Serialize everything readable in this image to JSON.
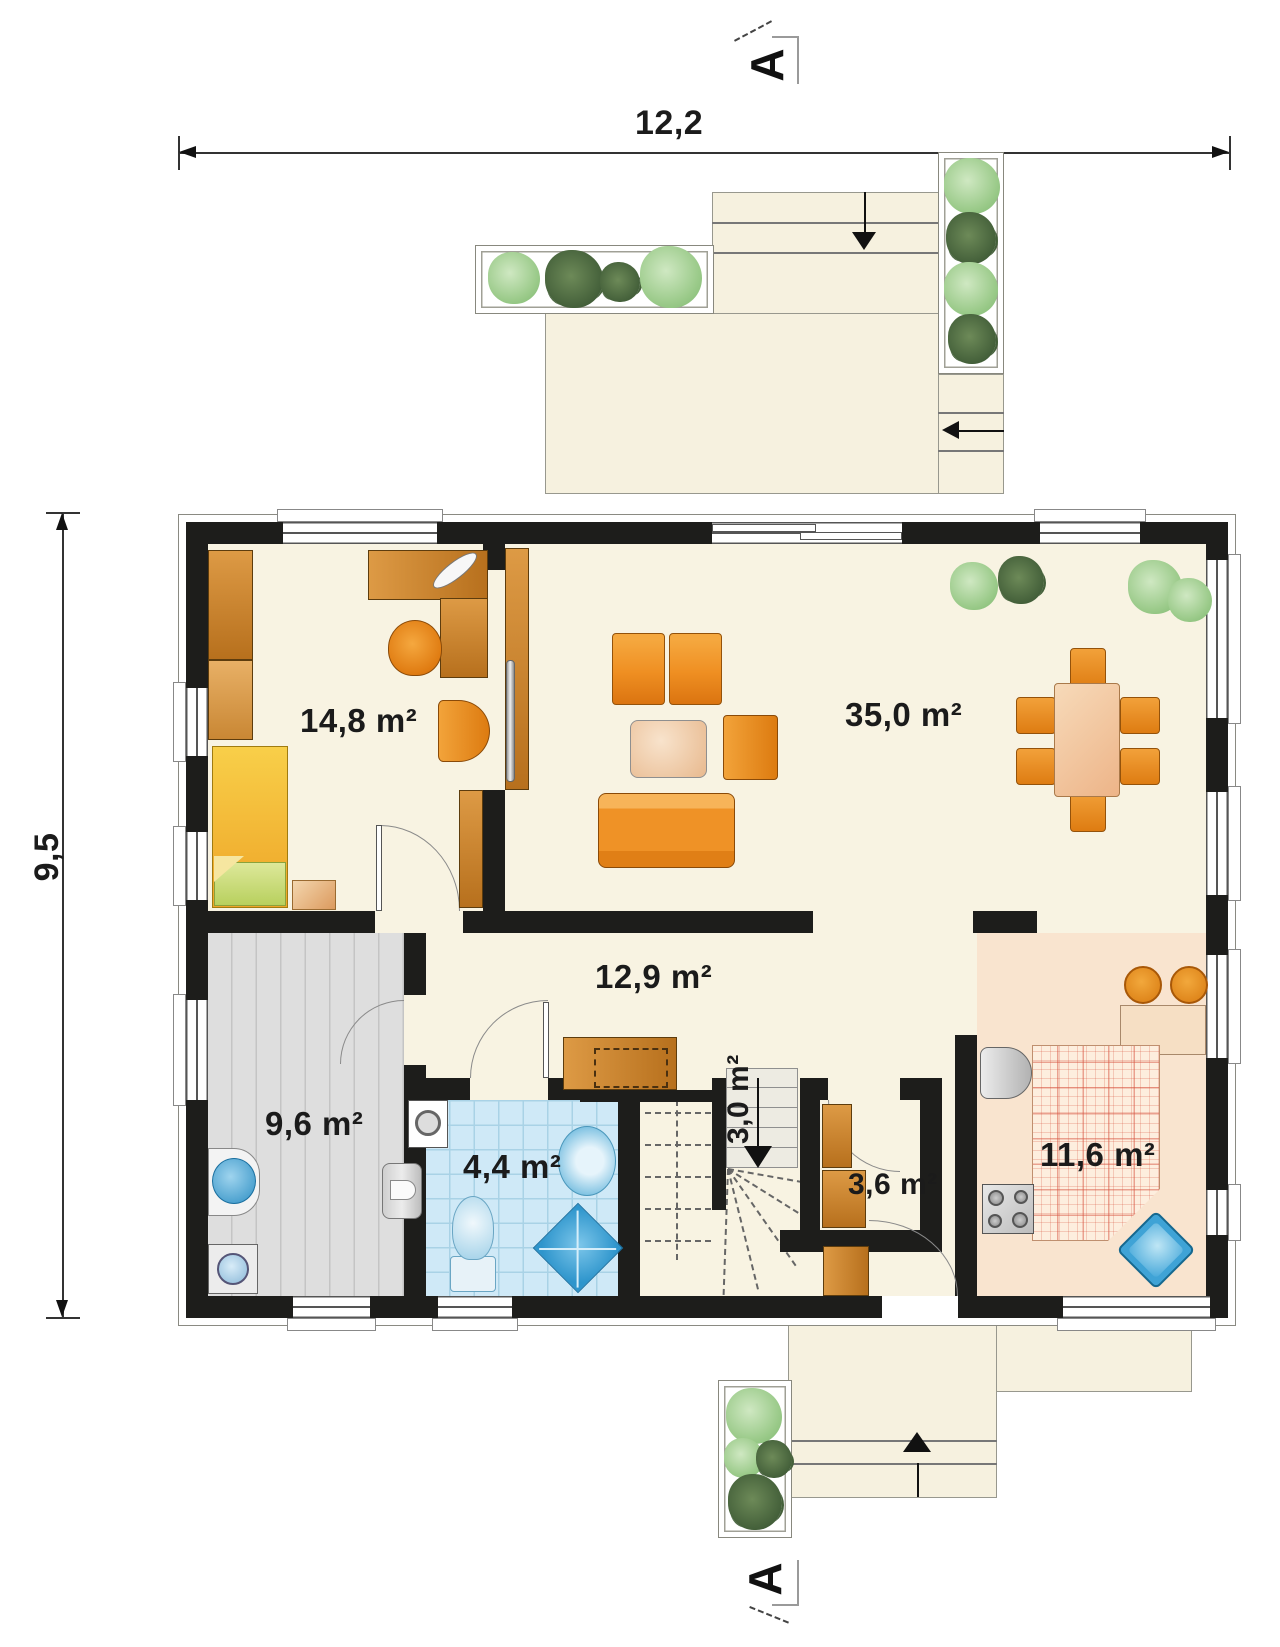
{
  "plan": {
    "title": "ground-floor-plan",
    "dimension_width": "12,2",
    "dimension_height": "9,5",
    "section_marker": "A",
    "rooms": [
      {
        "name": "bedroom",
        "area": "14,8 m²"
      },
      {
        "name": "living-dining",
        "area": "35,0 m²"
      },
      {
        "name": "hall",
        "area": "12,9 m²"
      },
      {
        "name": "utility",
        "area": "9,6 m²"
      },
      {
        "name": "bathroom",
        "area": "4,4 m²"
      },
      {
        "name": "staircase",
        "area": "3,0 m²"
      },
      {
        "name": "closet",
        "area": "3,6 m²"
      },
      {
        "name": "kitchen",
        "area": "11,6 m²"
      }
    ],
    "colors": {
      "wall": "#1d1d1b",
      "floor": "#f8f3e2",
      "terrace": "#f6f1df",
      "furniture_orange": "#ec8d2d",
      "wood": "#c9812f",
      "bath_tile": "#cfe9f7",
      "utility_floor": "#dedede",
      "kitchen_floor": "#f9e4cf",
      "fixture_blue": "#45aede",
      "plant_green": "#a9d49c"
    },
    "symbols": [
      "stairs-arrow",
      "entry-arrow",
      "terrace-arrow",
      "planter",
      "bed",
      "wardrobe",
      "desk",
      "office-chair",
      "armchair",
      "sofa",
      "coffee-table",
      "dining-table",
      "sideboard",
      "washing-machine",
      "water-heater",
      "laundry-sink",
      "toilet",
      "washbasin",
      "shower",
      "fridge",
      "stove",
      "kitchen-sink",
      "bar-counter",
      "bar-stool",
      "sliding-door",
      "houseplant"
    ]
  }
}
